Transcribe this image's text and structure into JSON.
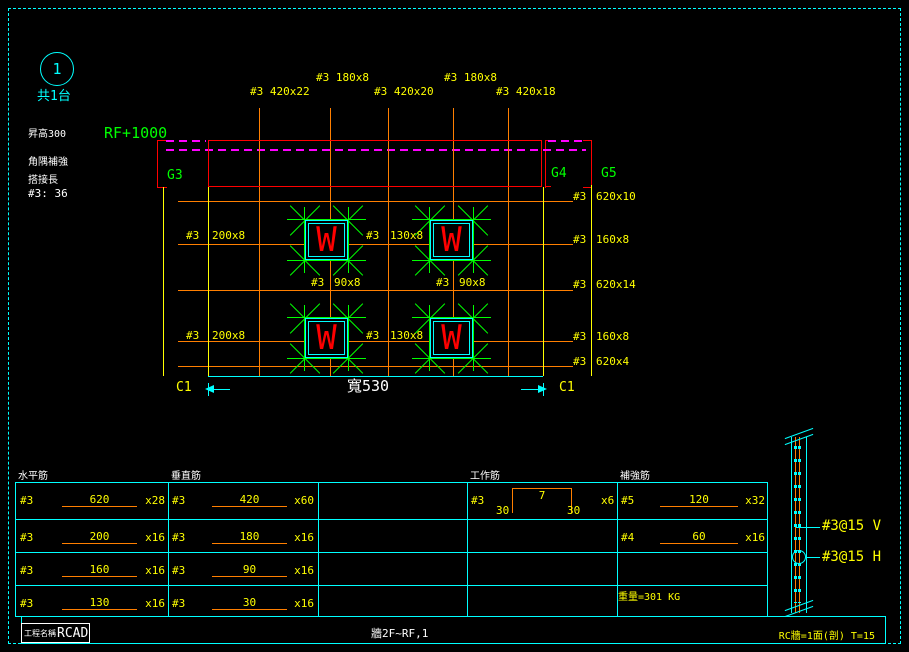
{
  "callout": {
    "number": "1",
    "count": "共1台"
  },
  "notes": {
    "raise": "昇高300",
    "corner": "角隅補強",
    "lap_title": "搭接長",
    "lap_value": "#3: 36"
  },
  "level": "RF+1000",
  "grids": {
    "g3": "G3",
    "g4": "G4",
    "g5": "G5"
  },
  "plan": {
    "top_labels": [
      "#3 180x8",
      "#3 180x8",
      "#3 420x22",
      "#3 420x20",
      "#3 420x18"
    ],
    "left": [
      {
        "bar": "#3",
        "size": "200x8"
      },
      {
        "bar": "#3",
        "size": "200x8"
      }
    ],
    "mid": [
      {
        "bar": "#3",
        "size": "130x8"
      },
      {
        "bar": "#3",
        "size": "130x8"
      }
    ],
    "mid90": [
      {
        "bar": "#3",
        "size": "90x8"
      },
      {
        "bar": "#3",
        "size": "90x8"
      }
    ],
    "right": [
      {
        "bar": "#3",
        "size": "620x10"
      },
      {
        "bar": "#3",
        "size": "160x8"
      },
      {
        "bar": "#3",
        "size": "620x14"
      },
      {
        "bar": "#3",
        "size": "160x8"
      },
      {
        "bar": "#3",
        "size": "620x4"
      }
    ],
    "opening_mark": "W",
    "width_dim": "寬530",
    "col_left": "C1",
    "col_right": "C1"
  },
  "section": {
    "v": "#3@15 V",
    "h": "#3@15 H"
  },
  "table": {
    "headers": [
      "水平筋",
      "垂直筋",
      "工作筋",
      "補強筋"
    ],
    "horizontal": [
      {
        "bar": "#3",
        "len": "620",
        "count": "x28"
      },
      {
        "bar": "#3",
        "len": "200",
        "count": "x16"
      },
      {
        "bar": "#3",
        "len": "160",
        "count": "x16"
      },
      {
        "bar": "#3",
        "len": "130",
        "count": "x16"
      }
    ],
    "vertical": [
      {
        "bar": "#3",
        "len": "420",
        "count": "x60"
      },
      {
        "bar": "#3",
        "len": "180",
        "count": "x16"
      },
      {
        "bar": "#3",
        "len": "90",
        "count": "x16"
      },
      {
        "bar": "#3",
        "len": "30",
        "count": "x16"
      }
    ],
    "work": {
      "bar": "#3",
      "top_len": "7",
      "leg_left": "30",
      "leg_right": "30",
      "count": "x6"
    },
    "reinforce": [
      {
        "bar": "#5",
        "len": "120",
        "count": "x32"
      },
      {
        "bar": "#4",
        "len": "60",
        "count": "x16"
      }
    ],
    "weight": "重量=301 KG"
  },
  "title_bar": {
    "project_label": "工程名稱",
    "project_value": "RCAD",
    "sheet": "牆2F~RF,1",
    "note": "RC牆=1面(剖) T=15"
  },
  "colors": {
    "cyan": "#00ffff",
    "yellow": "#ffff00",
    "orange": "#ff7f00",
    "red": "#ff0000",
    "green": "#00ff00",
    "magenta": "#ff00ff",
    "white": "#ffffff",
    "background": "#000000"
  }
}
